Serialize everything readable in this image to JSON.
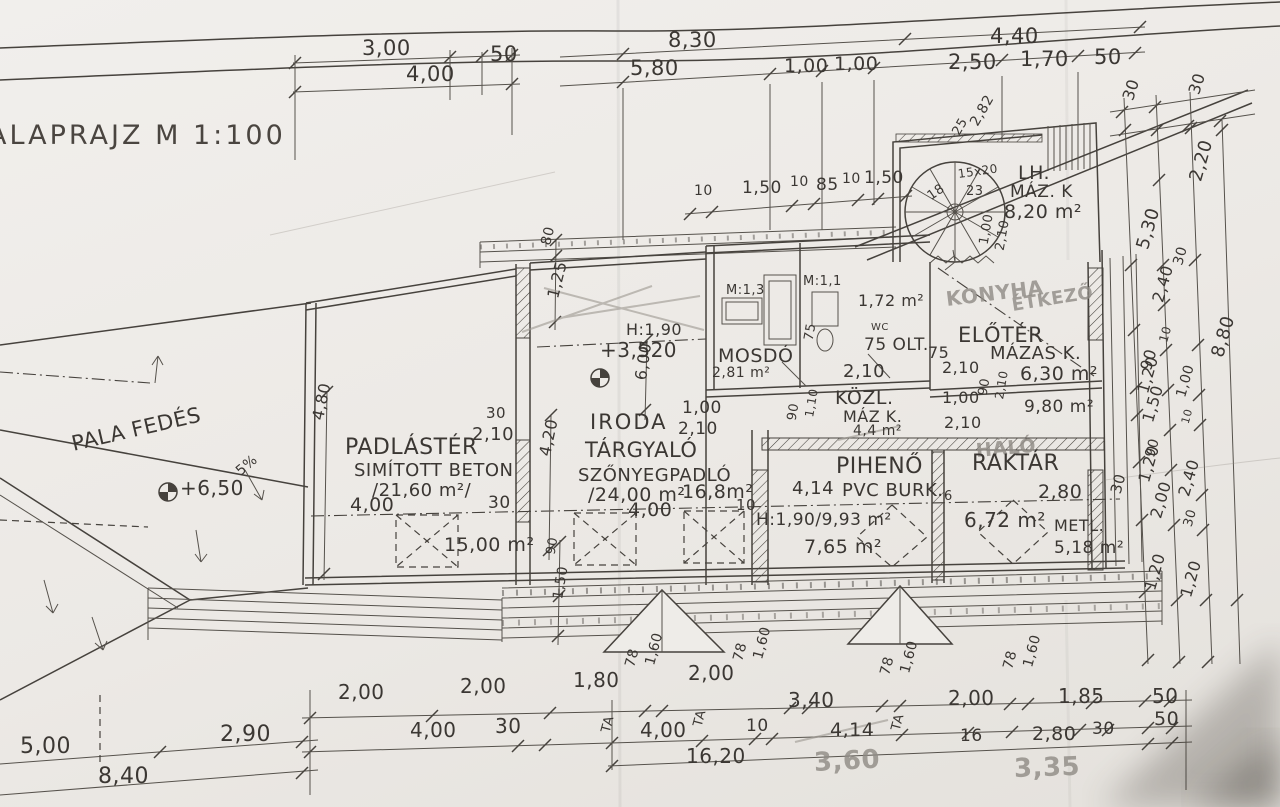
{
  "drawing": {
    "title": {
      "text": "ALAPRAJZ M 1:100"
    },
    "colors": {
      "paper": "#eeece8",
      "ink": "#46423d",
      "pencil": "#8f8b85",
      "shadow": "#3a352f"
    },
    "labels": [
      {
        "name": "dim",
        "text": "3,00",
        "x": 362,
        "y": 38,
        "s": 21
      },
      {
        "name": "dim",
        "text": "50",
        "x": 490,
        "y": 44,
        "s": 21
      },
      {
        "name": "dim",
        "text": "4,00",
        "x": 406,
        "y": 64,
        "s": 21
      },
      {
        "name": "dim",
        "text": "8,30",
        "x": 668,
        "y": 30,
        "s": 21
      },
      {
        "name": "dim",
        "text": "4,40",
        "x": 990,
        "y": 26,
        "s": 21
      },
      {
        "name": "dim",
        "text": "5,80",
        "x": 630,
        "y": 58,
        "s": 21
      },
      {
        "name": "dim",
        "text": "1,00",
        "x": 784,
        "y": 57,
        "s": 19
      },
      {
        "name": "dim",
        "text": "1,00",
        "x": 834,
        "y": 55,
        "s": 19
      },
      {
        "name": "dim",
        "text": "2,50",
        "x": 948,
        "y": 52,
        "s": 21
      },
      {
        "name": "dim",
        "text": "1,70",
        "x": 1020,
        "y": 49,
        "s": 21
      },
      {
        "name": "dim",
        "text": "50",
        "x": 1094,
        "y": 47,
        "s": 21
      },
      {
        "name": "dim",
        "text": "30",
        "x": 1128,
        "y": 92,
        "s": 16,
        "r": -72
      },
      {
        "name": "dim",
        "text": "30",
        "x": 1194,
        "y": 86,
        "s": 16,
        "r": -72
      },
      {
        "name": "dim",
        "text": "25",
        "x": 956,
        "y": 128,
        "s": 13,
        "r": -60
      },
      {
        "name": "dim",
        "text": "2,82",
        "x": 974,
        "y": 118,
        "s": 14,
        "r": -60
      },
      {
        "name": "stair-riser-note",
        "text": "15x20",
        "x": 958,
        "y": 168,
        "s": 12,
        "r": -8
      },
      {
        "name": "stair-step-num",
        "text": "18",
        "x": 929,
        "y": 191,
        "s": 13,
        "r": -35
      },
      {
        "name": "stair-step-num",
        "text": "23",
        "x": 966,
        "y": 185,
        "s": 13
      },
      {
        "name": "room-label-lh",
        "text": "LH.",
        "x": 1018,
        "y": 164,
        "s": 19
      },
      {
        "name": "finish-label",
        "text": "MÁZ. K",
        "x": 1010,
        "y": 184,
        "s": 17
      },
      {
        "name": "area-lh",
        "text": "8,20 m²",
        "x": 1004,
        "y": 203,
        "s": 19
      },
      {
        "name": "dim",
        "text": "2,20",
        "x": 1196,
        "y": 172,
        "s": 18,
        "r": -74
      },
      {
        "name": "dim",
        "text": "5,30",
        "x": 1143,
        "y": 240,
        "s": 18,
        "r": -74
      },
      {
        "name": "dim",
        "text": "30",
        "x": 1178,
        "y": 258,
        "s": 14,
        "r": -74
      },
      {
        "name": "dim",
        "text": "2,40",
        "x": 1158,
        "y": 294,
        "s": 16,
        "r": -74
      },
      {
        "name": "dim",
        "text": "10",
        "x": 1163,
        "y": 336,
        "s": 12,
        "r": -74
      },
      {
        "name": "dim",
        "text": "90",
        "x": 1146,
        "y": 362,
        "s": 16,
        "r": -74
      },
      {
        "name": "dim",
        "text": "8,80",
        "x": 1218,
        "y": 348,
        "s": 18,
        "r": -74
      },
      {
        "name": "dim",
        "text": "1,00",
        "x": 984,
        "y": 238,
        "s": 13,
        "r": -80
      },
      {
        "name": "dim",
        "text": "2,10",
        "x": 1000,
        "y": 244,
        "s": 13,
        "r": -80
      },
      {
        "name": "dim",
        "text": "10",
        "x": 694,
        "y": 184,
        "s": 14
      },
      {
        "name": "dim",
        "text": "1,50",
        "x": 742,
        "y": 180,
        "s": 17
      },
      {
        "name": "dim",
        "text": "10",
        "x": 790,
        "y": 175,
        "s": 14
      },
      {
        "name": "dim",
        "text": "85",
        "x": 816,
        "y": 177,
        "s": 17
      },
      {
        "name": "dim",
        "text": "10",
        "x": 842,
        "y": 172,
        "s": 14
      },
      {
        "name": "dim",
        "text": "1,50",
        "x": 864,
        "y": 170,
        "s": 17
      },
      {
        "name": "dim",
        "text": "80",
        "x": 546,
        "y": 238,
        "s": 14,
        "r": -76
      },
      {
        "name": "dim",
        "text": "1,25",
        "x": 553,
        "y": 290,
        "s": 16,
        "r": -76
      },
      {
        "name": "headroom-note",
        "text": "H:1,90",
        "x": 626,
        "y": 322,
        "s": 16
      },
      {
        "name": "level-note",
        "text": "+3,520",
        "x": 600,
        "y": 340,
        "s": 20
      },
      {
        "name": "dim",
        "text": "6,00",
        "x": 641,
        "y": 372,
        "s": 16,
        "r": -82
      },
      {
        "name": "room-label-iroda",
        "text": "IRODA",
        "x": 590,
        "y": 412,
        "s": 21,
        "cls": "room"
      },
      {
        "name": "dim",
        "text": "1,00",
        "x": 682,
        "y": 400,
        "s": 17
      },
      {
        "name": "dim",
        "text": "2,10",
        "x": 678,
        "y": 421,
        "s": 17
      },
      {
        "name": "room-label-targyalo",
        "text": "TÁRGYALÓ",
        "x": 585,
        "y": 440,
        "s": 21
      },
      {
        "name": "finish-label",
        "text": "SZŐNYEGPADLÓ",
        "x": 578,
        "y": 467,
        "s": 18
      },
      {
        "name": "area-targyalo",
        "text": "/24,00 m²",
        "x": 588,
        "y": 486,
        "s": 19
      },
      {
        "name": "area-note",
        "text": "16,8m²",
        "x": 682,
        "y": 483,
        "s": 19
      },
      {
        "name": "dim",
        "text": "4,00",
        "x": 628,
        "y": 501,
        "s": 19
      },
      {
        "name": "dim",
        "text": "10",
        "x": 736,
        "y": 498,
        "s": 15
      },
      {
        "name": "roof-note",
        "text": "PALA FEDÉS",
        "x": 72,
        "y": 434,
        "s": 21,
        "r": -13
      },
      {
        "name": "level-note",
        "text": "+6,50",
        "x": 180,
        "y": 478,
        "s": 20
      },
      {
        "name": "slope-note",
        "text": "5%",
        "x": 238,
        "y": 466,
        "s": 14,
        "r": -40
      },
      {
        "name": "room-label-padlaster",
        "text": "PADLÁSTÉR",
        "x": 345,
        "y": 437,
        "s": 22
      },
      {
        "name": "finish-label",
        "text": "SIMÍTOTT BETON",
        "x": 354,
        "y": 462,
        "s": 18
      },
      {
        "name": "area-padlaster",
        "text": "/21,60 m²/",
        "x": 372,
        "y": 482,
        "s": 18
      },
      {
        "name": "dim",
        "text": "2,10",
        "x": 472,
        "y": 426,
        "s": 18
      },
      {
        "name": "dim",
        "text": "30",
        "x": 486,
        "y": 406,
        "s": 15
      },
      {
        "name": "dim",
        "text": "4,00",
        "x": 350,
        "y": 496,
        "s": 19
      },
      {
        "name": "area-note",
        "text": "15,00 m²",
        "x": 444,
        "y": 536,
        "s": 19
      },
      {
        "name": "dim",
        "text": "30",
        "x": 488,
        "y": 495,
        "s": 17
      },
      {
        "name": "dim",
        "text": "4,80",
        "x": 318,
        "y": 412,
        "s": 16,
        "r": -78
      },
      {
        "name": "dim",
        "text": "4,20",
        "x": 545,
        "y": 448,
        "s": 16,
        "r": -78
      },
      {
        "name": "scale-note",
        "text": "M:1,3",
        "x": 726,
        "y": 284,
        "s": 13
      },
      {
        "name": "scale-note",
        "text": "M:1,1",
        "x": 803,
        "y": 275,
        "s": 13
      },
      {
        "name": "area-note",
        "text": "1,72 m²",
        "x": 858,
        "y": 293,
        "s": 16
      },
      {
        "name": "room-label-wc",
        "text": "WC",
        "x": 871,
        "y": 323,
        "s": 10
      },
      {
        "name": "note",
        "text": "75 OLT.",
        "x": 864,
        "y": 337,
        "s": 17
      },
      {
        "name": "dim",
        "text": "75",
        "x": 809,
        "y": 334,
        "s": 13,
        "r": -80
      },
      {
        "name": "room-label-mosdo",
        "text": "MOSDÓ",
        "x": 718,
        "y": 347,
        "s": 19
      },
      {
        "name": "area-mosdo",
        "text": "2,81 m²",
        "x": 712,
        "y": 366,
        "s": 14
      },
      {
        "name": "dim",
        "text": "2,10",
        "x": 843,
        "y": 363,
        "s": 18
      },
      {
        "name": "room-label-kozl",
        "text": "KÖZL.",
        "x": 835,
        "y": 389,
        "s": 19
      },
      {
        "name": "finish-label",
        "text": "MÁZ K.",
        "x": 843,
        "y": 409,
        "s": 16
      },
      {
        "name": "area-kozl",
        "text": "4,4 m²",
        "x": 853,
        "y": 424,
        "s": 14
      },
      {
        "name": "dim",
        "text": "90",
        "x": 792,
        "y": 414,
        "s": 13,
        "r": -80
      },
      {
        "name": "dim",
        "text": "1,10",
        "x": 809,
        "y": 411,
        "s": 12,
        "r": -80
      },
      {
        "name": "dim",
        "text": "1,00",
        "x": 942,
        "y": 390,
        "s": 16
      },
      {
        "name": "dim",
        "text": "2,10",
        "x": 944,
        "y": 415,
        "s": 16
      },
      {
        "name": "dim",
        "text": "90",
        "x": 983,
        "y": 389,
        "s": 13,
        "r": -80
      },
      {
        "name": "dim",
        "text": "2,10",
        "x": 999,
        "y": 393,
        "s": 12,
        "r": -80
      },
      {
        "name": "area-note",
        "text": "9,80 m²",
        "x": 1024,
        "y": 399,
        "s": 17
      },
      {
        "name": "pencil-note-konyha",
        "text": "KONYHA",
        "x": 946,
        "y": 289,
        "s": 20,
        "r": -7,
        "cls": "pencil"
      },
      {
        "name": "pencil-note-etkezo",
        "text": "ÉTKEZŐ",
        "x": 1012,
        "y": 297,
        "s": 18,
        "r": -9,
        "cls": "pencil"
      },
      {
        "name": "room-label-eloter",
        "text": "ELŐTÉR",
        "x": 958,
        "y": 325,
        "s": 21
      },
      {
        "name": "dim",
        "text": "75",
        "x": 928,
        "y": 345,
        "s": 16
      },
      {
        "name": "finish-label",
        "text": "MÁZAS K.",
        "x": 990,
        "y": 345,
        "s": 18
      },
      {
        "name": "area-eloter",
        "text": "6,30 m²",
        "x": 1020,
        "y": 365,
        "s": 19
      },
      {
        "name": "dim",
        "text": "2,10",
        "x": 942,
        "y": 360,
        "s": 16
      },
      {
        "name": "dim",
        "text": "1,20",
        "x": 1143,
        "y": 385,
        "s": 16,
        "r": -74
      },
      {
        "name": "pencil-note-halo",
        "text": "HÁLÓ",
        "x": 976,
        "y": 442,
        "s": 19,
        "r": -5,
        "cls": "pencil"
      },
      {
        "name": "room-label-piheno",
        "text": "PIHENŐ",
        "x": 836,
        "y": 456,
        "s": 22
      },
      {
        "name": "room-label-raktar",
        "text": "RAKTÁR",
        "x": 972,
        "y": 453,
        "s": 22
      },
      {
        "name": "dim",
        "text": "4,14",
        "x": 792,
        "y": 480,
        "s": 18
      },
      {
        "name": "finish-label",
        "text": "PVC BURK.",
        "x": 842,
        "y": 482,
        "s": 18
      },
      {
        "name": "dim",
        "text": "6",
        "x": 944,
        "y": 490,
        "s": 13
      },
      {
        "name": "dim",
        "text": "2,80",
        "x": 1038,
        "y": 483,
        "s": 19
      },
      {
        "name": "area-piheno",
        "text": "H:1,90/9,93 m²",
        "x": 756,
        "y": 512,
        "s": 17
      },
      {
        "name": "area-note",
        "text": "7,65 m²",
        "x": 804,
        "y": 538,
        "s": 19
      },
      {
        "name": "area-raktar",
        "text": "6,72 m²",
        "x": 964,
        "y": 510,
        "s": 20
      },
      {
        "name": "finish-label",
        "text": "METL.",
        "x": 1054,
        "y": 518,
        "s": 16
      },
      {
        "name": "area-note",
        "text": "5,18 m²",
        "x": 1054,
        "y": 540,
        "s": 17
      },
      {
        "name": "dim",
        "text": "30",
        "x": 1116,
        "y": 486,
        "s": 15,
        "r": -75
      },
      {
        "name": "dim",
        "text": "1,50",
        "x": 1148,
        "y": 414,
        "s": 16,
        "r": -74
      },
      {
        "name": "dim",
        "text": "1,00",
        "x": 1181,
        "y": 390,
        "s": 14,
        "r": -74
      },
      {
        "name": "dim",
        "text": "10",
        "x": 1185,
        "y": 418,
        "s": 11,
        "r": -74
      },
      {
        "name": "dim",
        "text": "90",
        "x": 1150,
        "y": 450,
        "s": 14,
        "r": -74
      },
      {
        "name": "dim",
        "text": "1,20",
        "x": 1144,
        "y": 474,
        "s": 16,
        "r": -74
      },
      {
        "name": "dim",
        "text": "2,40",
        "x": 1184,
        "y": 488,
        "s": 16,
        "r": -74
      },
      {
        "name": "dim",
        "text": "2,00",
        "x": 1156,
        "y": 510,
        "s": 16,
        "r": -74
      },
      {
        "name": "dim",
        "text": "30",
        "x": 1188,
        "y": 520,
        "s": 13,
        "r": -74
      },
      {
        "name": "dim",
        "text": "1,20",
        "x": 1150,
        "y": 582,
        "s": 16,
        "r": -74
      },
      {
        "name": "dim",
        "text": "1,20",
        "x": 1186,
        "y": 589,
        "s": 16,
        "r": -74
      },
      {
        "name": "dim",
        "text": "90",
        "x": 551,
        "y": 548,
        "s": 13,
        "r": -80
      },
      {
        "name": "dim",
        "text": "1,50",
        "x": 558,
        "y": 592,
        "s": 14,
        "r": -80
      },
      {
        "name": "dim",
        "text": "2,00",
        "x": 338,
        "y": 682,
        "s": 20
      },
      {
        "name": "dim",
        "text": "2,00",
        "x": 460,
        "y": 676,
        "s": 20
      },
      {
        "name": "dim",
        "text": "1,80",
        "x": 573,
        "y": 670,
        "s": 20
      },
      {
        "name": "dim",
        "text": "78",
        "x": 630,
        "y": 660,
        "s": 14,
        "r": -75
      },
      {
        "name": "dim",
        "text": "1,60",
        "x": 650,
        "y": 658,
        "s": 14,
        "r": -75
      },
      {
        "name": "dim",
        "text": "2,00",
        "x": 688,
        "y": 663,
        "s": 20
      },
      {
        "name": "dim",
        "text": "78",
        "x": 738,
        "y": 654,
        "s": 14,
        "r": -75
      },
      {
        "name": "dim",
        "text": "1,60",
        "x": 758,
        "y": 652,
        "s": 14,
        "r": -75
      },
      {
        "name": "dim",
        "text": "3,40",
        "x": 788,
        "y": 690,
        "s": 20
      },
      {
        "name": "dim",
        "text": "78",
        "x": 885,
        "y": 668,
        "s": 14,
        "r": -75
      },
      {
        "name": "dim",
        "text": "1,60",
        "x": 905,
        "y": 666,
        "s": 14,
        "r": -75
      },
      {
        "name": "dim",
        "text": "2,00",
        "x": 948,
        "y": 688,
        "s": 20
      },
      {
        "name": "dim",
        "text": "78",
        "x": 1008,
        "y": 662,
        "s": 14,
        "r": -75
      },
      {
        "name": "dim",
        "text": "1,60",
        "x": 1028,
        "y": 660,
        "s": 14,
        "r": -75
      },
      {
        "name": "dim",
        "text": "1,85",
        "x": 1058,
        "y": 686,
        "s": 20
      },
      {
        "name": "dim",
        "text": "50",
        "x": 1152,
        "y": 686,
        "s": 20
      },
      {
        "name": "dim",
        "text": "4,00",
        "x": 410,
        "y": 720,
        "s": 20
      },
      {
        "name": "dim",
        "text": "30",
        "x": 495,
        "y": 716,
        "s": 20
      },
      {
        "name": "window-mark",
        "text": "TA",
        "x": 606,
        "y": 726,
        "s": 13,
        "r": -75
      },
      {
        "name": "dim",
        "text": "4,00",
        "x": 640,
        "y": 720,
        "s": 20
      },
      {
        "name": "window-mark",
        "text": "TA",
        "x": 698,
        "y": 720,
        "s": 13,
        "r": -75
      },
      {
        "name": "dim",
        "text": "10",
        "x": 746,
        "y": 718,
        "s": 17
      },
      {
        "name": "dim",
        "text": "4,14",
        "x": 830,
        "y": 721,
        "s": 19
      },
      {
        "name": "window-mark",
        "text": "TA",
        "x": 896,
        "y": 724,
        "s": 13,
        "r": -75
      },
      {
        "name": "dim",
        "text": "16",
        "x": 960,
        "y": 728,
        "s": 17
      },
      {
        "name": "dim",
        "text": "2,80",
        "x": 1032,
        "y": 725,
        "s": 19
      },
      {
        "name": "dim",
        "text": "30",
        "x": 1092,
        "y": 721,
        "s": 17
      },
      {
        "name": "dim",
        "text": "50",
        "x": 1154,
        "y": 710,
        "s": 19
      },
      {
        "name": "dim",
        "text": "16,20",
        "x": 686,
        "y": 746,
        "s": 20
      },
      {
        "name": "pencil-dim",
        "text": "3,60",
        "x": 814,
        "y": 750,
        "s": 26,
        "r": -3,
        "cls": "pencil"
      },
      {
        "name": "pencil-dim",
        "text": "3,35",
        "x": 1014,
        "y": 756,
        "s": 26,
        "r": -2,
        "cls": "pencil"
      },
      {
        "name": "dim",
        "text": "5,00",
        "x": 20,
        "y": 736,
        "s": 22
      },
      {
        "name": "dim",
        "text": "2,90",
        "x": 220,
        "y": 724,
        "s": 22
      },
      {
        "name": "dim",
        "text": "8,40",
        "x": 98,
        "y": 766,
        "s": 22
      }
    ]
  }
}
